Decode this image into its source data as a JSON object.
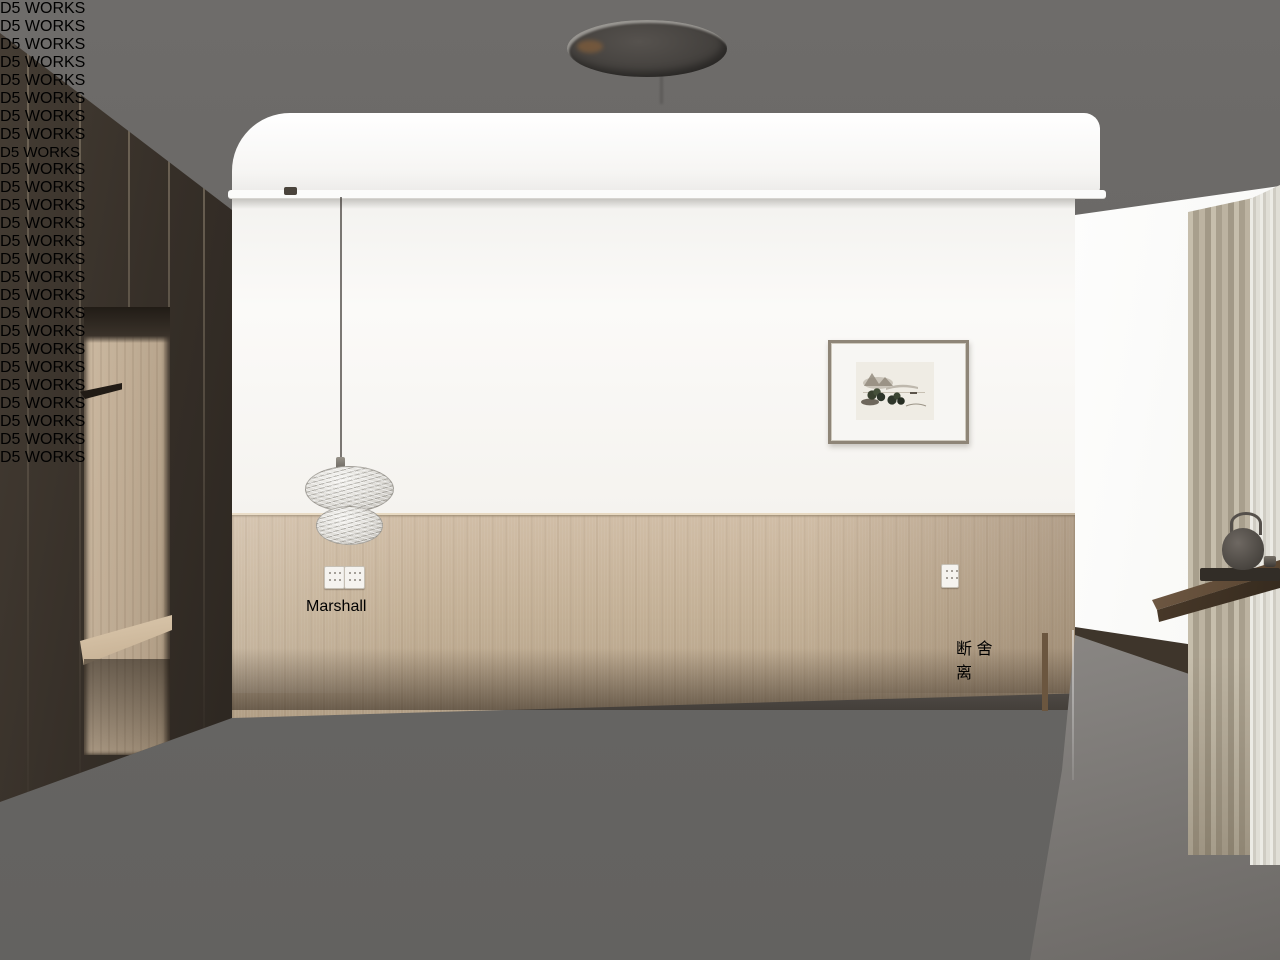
{
  "scene": {
    "type": "3d-interior-render",
    "room": "bedroom",
    "style": "japandi wood-and-white bedroom with window bay"
  },
  "watermark": {
    "label": "D5 WORKS",
    "logo": "d5-pin-logo",
    "text_color": "#ffffff"
  },
  "speaker": {
    "brand": "Marshall"
  },
  "poster": {
    "chars": [
      "断",
      "舍",
      "离"
    ],
    "seal_color": "#c49a4a"
  },
  "palette": {
    "ceiling": "#6b6968",
    "wardrobe": "#3a332b",
    "wall": "#f9f8f6",
    "wainscot": "#c4b197",
    "wood_accent": "#c9a87c",
    "floor": "#3b322a",
    "rug": "#423d37",
    "duvet": "#d3d2cf",
    "curtain": "#b5ac9b"
  }
}
